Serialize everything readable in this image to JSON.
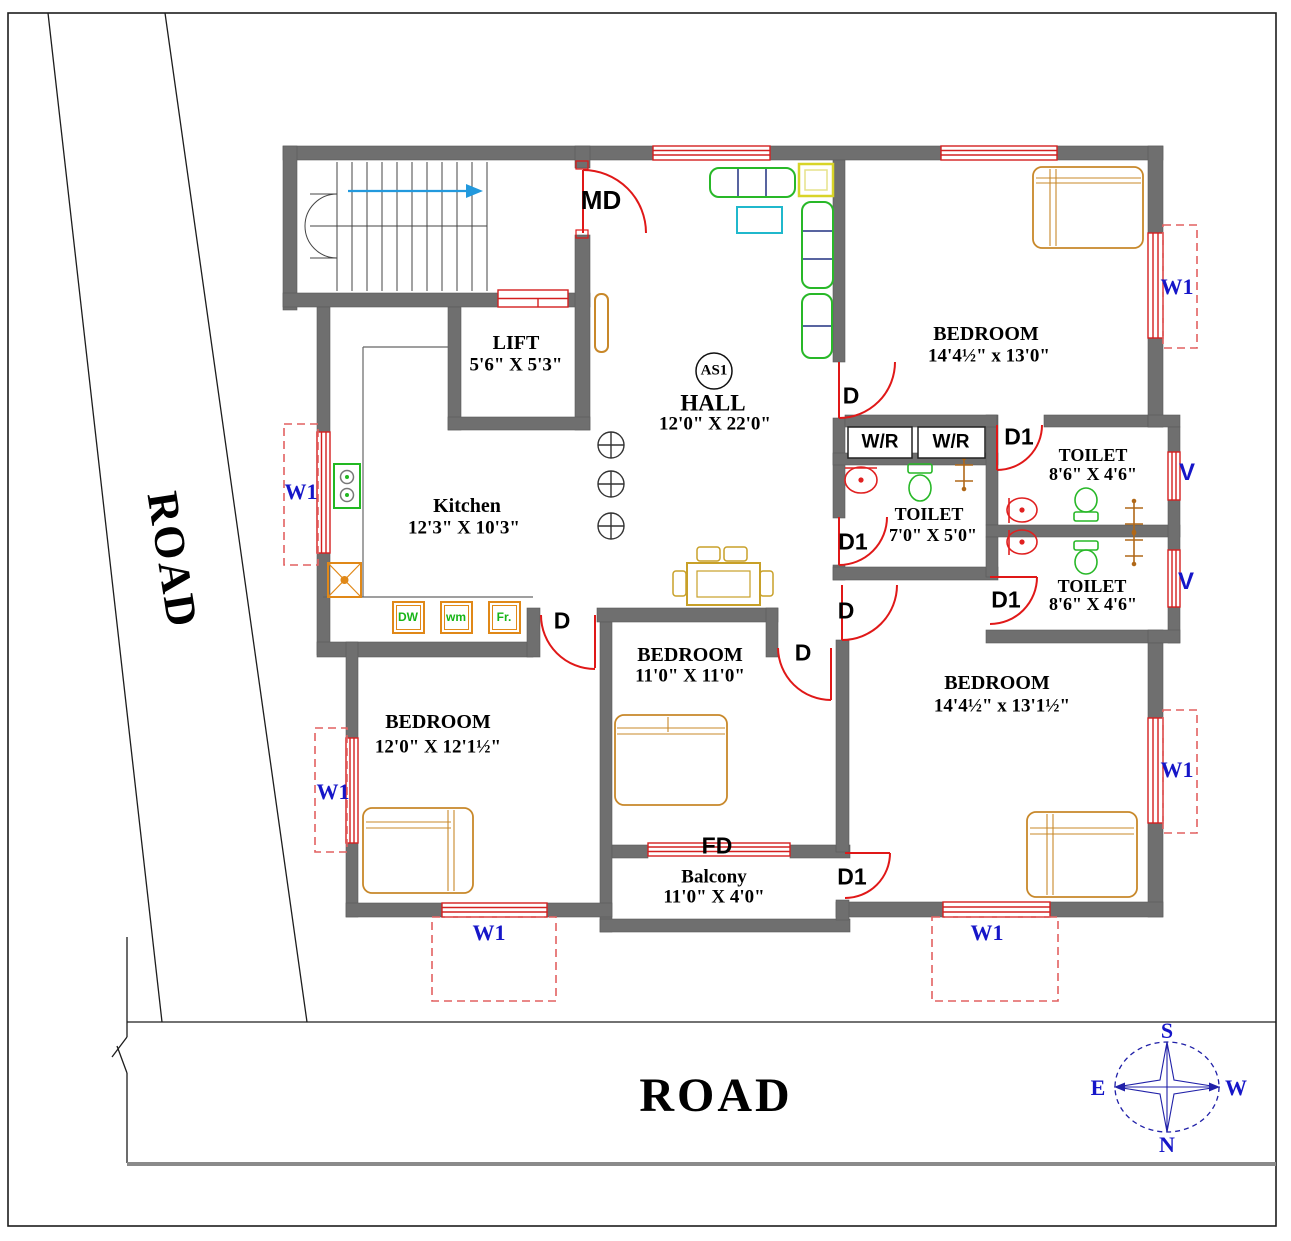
{
  "roads": {
    "left": "ROAD",
    "bottom": "ROAD"
  },
  "compass": {
    "top": "S",
    "bottom": "N",
    "left": "E",
    "right": "W"
  },
  "rooms": {
    "lift": {
      "name": "LIFT",
      "dim": "5'6\" X 5'3\""
    },
    "hall": {
      "name": "HALL",
      "dim": "12'0\" X 22'0\"",
      "tag": "AS1"
    },
    "kitchen": {
      "name": "Kitchen",
      "dim": "12'3\" X 10'3\""
    },
    "bedroom_top_right": {
      "name": "BEDROOM",
      "dim": "14'4½\" x 13'0\""
    },
    "toilet_top": {
      "name": "TOILET",
      "dim": "8'6\" X 4'6\""
    },
    "toilet_mid": {
      "name": "TOILET",
      "dim": "7'0\" X 5'0\""
    },
    "toilet_bottom": {
      "name": "TOILET",
      "dim": "8'6\" X 4'6\""
    },
    "bedroom_mid": {
      "name": "BEDROOM",
      "dim": "11'0\" X 11'0\""
    },
    "bedroom_bottom_left": {
      "name": "BEDROOM",
      "dim": "12'0\" X 12'1½\""
    },
    "bedroom_bottom_right": {
      "name": "BEDROOM",
      "dim": "14'4½\" x 13'1½\""
    },
    "balcony": {
      "name": "Balcony",
      "dim": "11'0\" X 4'0\""
    }
  },
  "doors": {
    "main": "MD",
    "standard": "D",
    "type1": "D1",
    "folding": "FD"
  },
  "windows": {
    "window1": "W1",
    "ventilator": "V"
  },
  "storage": {
    "washroom_rack": "W/R"
  },
  "appliances": {
    "dishwasher": "DW",
    "washing_machine": "wm",
    "fridge": "Fr."
  },
  "colors": {
    "wall": "#6f6f6f",
    "door_red": "#e01818",
    "window_red": "#d42020",
    "label_blue": "#1616c8",
    "dashed_red": "#e26060",
    "sofa_green": "#28b828",
    "bed_tan": "#c8882a",
    "table_khaki": "#c8a028",
    "coffee_cyan": "#20b8cc",
    "side_table_yellow": "#d8d428",
    "appliance_orange": "#e08818",
    "shower_brown": "#b06818",
    "stair_arrow_blue": "#2299dd",
    "compass_blue": "#2020a8"
  }
}
